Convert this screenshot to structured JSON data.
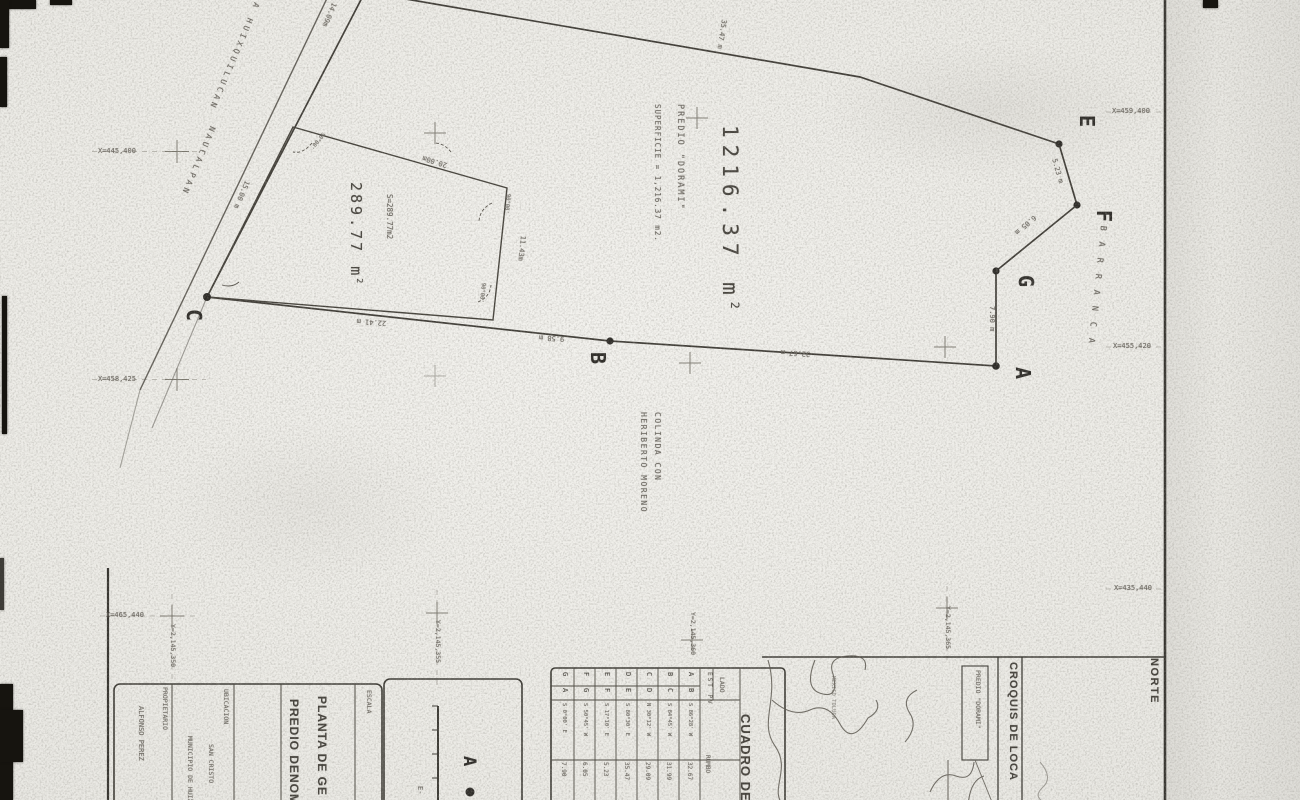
{
  "drawing": {
    "parcel_main": {
      "area": "1216.37 m",
      "area_sup": "2",
      "predio": "PREDIO \"DORAMI\"",
      "superficie": "SUPERFICIE = 1,216.37 m2."
    },
    "parcel_small": {
      "area": "289.77 m",
      "area_sup": "2",
      "s_label": "S=289.77m2"
    },
    "colinda": {
      "line1": "COLINDA CON",
      "line2": "HERIBERTO MORENO"
    },
    "road": {
      "name1": "CARRETERA HUIXQUILUCAN",
      "name2": "NAUCALPAN"
    },
    "barranca": "BARRANCA",
    "vertices": {
      "a": "A",
      "b": "B",
      "c": "C",
      "e": "E",
      "f": "F",
      "g": "G"
    },
    "measurements": [
      "14.09m",
      "15.00 m",
      "35.47 m",
      "5.23 m",
      "6.05 m",
      "7.90 m",
      "32.67 m",
      "9.58 m",
      "22.41 m",
      "20.00m",
      "11.43m",
      "90°00'",
      "90°00'",
      "90°00'"
    ]
  },
  "grid": {
    "left": [
      "X=445,400",
      "X=458,425",
      "X=465,440"
    ],
    "right": [
      "X=459,400",
      "X=455,420",
      "X=435,440"
    ],
    "y": [
      "Y=2,145,350",
      "Y=2,145,355",
      "Y=2,145,360",
      "Y=2,145,365"
    ]
  },
  "titleblock": {
    "title1": "PLANTA DE GE",
    "title2": "PREDIO DENOM",
    "ubicacion_label": "UBICACION",
    "ubicacion_line1": "SAN CRISTO",
    "ubicacion_line2": "MUNICIPIO DE HUIXQ",
    "propietario_label": "PROPIETARIO",
    "propietario_name": "ALFONSO PEREZ",
    "escala_label": "ESCALA",
    "escala_value": "E-",
    "legend_vertex": "A"
  },
  "cuadro": {
    "title": "CUADRO DE",
    "lado_label": "LADO",
    "estpv_label": "EST PV",
    "rumbo_label": "RUMBO",
    "rows": [
      {
        "est": "A",
        "pv": "B",
        "rumbo": "S 86°28' W",
        "dist": "32.67"
      },
      {
        "est": "B",
        "pv": "C",
        "rumbo": "S 84°45' W",
        "dist": "31.99"
      },
      {
        "est": "C",
        "pv": "D",
        "rumbo": "N 30°12' W",
        "dist": "29.09"
      },
      {
        "est": "D",
        "pv": "E",
        "rumbo": "S 80°30' E",
        "dist": "35.47"
      },
      {
        "est": "E",
        "pv": "F",
        "rumbo": "S 17°10' E",
        "dist": "5.23"
      },
      {
        "est": "F",
        "pv": "G",
        "rumbo": "S 50°45' W",
        "dist": "6.05"
      },
      {
        "est": "G",
        "pv": "A",
        "rumbo": "S 0°00' E",
        "dist": "7.90"
      }
    ]
  },
  "croquis": {
    "title": "CROQUIS DE LOCA",
    "norte_label": "NORTE",
    "predio_tag": "PREDIO \"DORAMI\"",
    "road_tag": "MEXICO TOLUCA"
  }
}
